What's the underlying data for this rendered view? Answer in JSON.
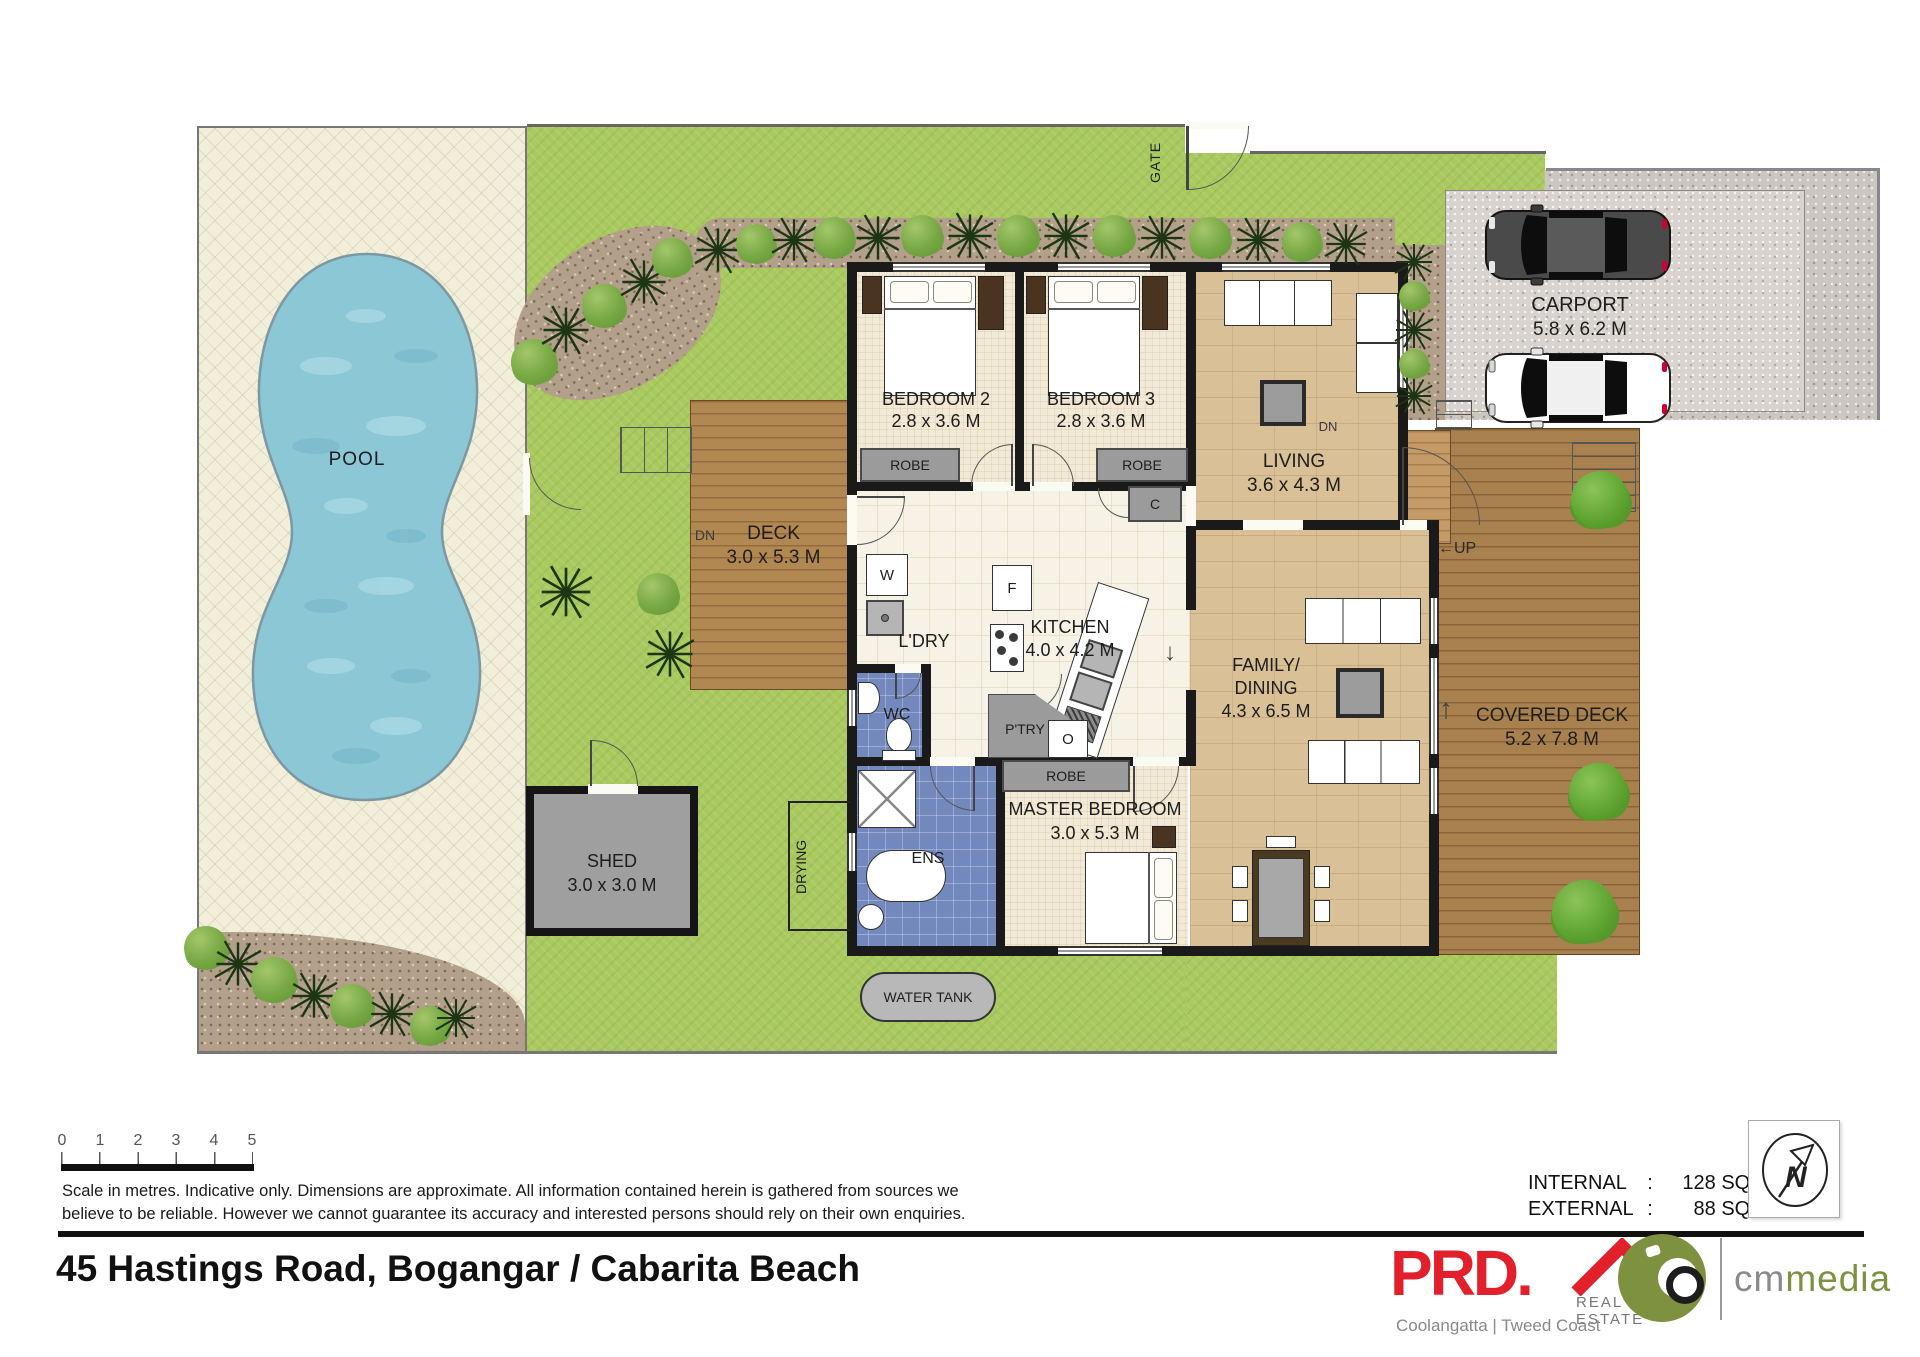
{
  "colors": {
    "prd_red": "#e2202c",
    "cm_green": "#7d9140",
    "water_blue": "#8cc7d6",
    "lawn_green": "#a9c95f",
    "mulch_brown": "#b3a08a",
    "wet_area_blue": "#7388bd",
    "deck_wood": "#b18752",
    "wall_black": "#1a1a1a"
  },
  "plan": {
    "gate_label": "GATE",
    "pool": {
      "label": "POOL"
    },
    "deck": {
      "label": "DECK",
      "dims": "3.0 x 5.3 M",
      "dn": "DN"
    },
    "shed": {
      "label": "SHED",
      "dims": "3.0 x 3.0 M"
    },
    "water_tank": {
      "label": "WATER TANK"
    },
    "drying": {
      "label": "DRYING"
    },
    "bedroom2": {
      "label": "BEDROOM 2",
      "dims": "2.8 x 3.6 M",
      "robe": "ROBE"
    },
    "bedroom3": {
      "label": "BEDROOM 3",
      "dims": "2.8 x 3.6 M",
      "robe": "ROBE"
    },
    "cupboard": "C",
    "living": {
      "label": "LIVING",
      "dims": "3.6 x 4.3 M"
    },
    "kitchen": {
      "label": "KITCHEN",
      "dims": "4.0 x 4.2 M",
      "fridge": "F",
      "oven": "O",
      "pantry": "P'TRY"
    },
    "laundry": {
      "label": "L'DRY",
      "washer": "W"
    },
    "wc": {
      "label": "WC"
    },
    "ens": {
      "label": "ENS"
    },
    "master": {
      "label": "MASTER BEDROOM",
      "dims": "3.0 x 5.3 M",
      "robe": "ROBE"
    },
    "family": {
      "line1": "FAMILY/",
      "line2": "DINING",
      "dims": "4.3 x 6.5 M"
    },
    "covered_deck": {
      "label": "COVERED DECK",
      "dims": "5.2 x 7.8 M"
    },
    "carport": {
      "label": "CARPORT",
      "dims": "5.8 x 6.2 M",
      "dn": "DN"
    },
    "up_label": "←UP",
    "arrow_up": "↑",
    "arrow_down": "↓"
  },
  "footer": {
    "scale_ticks": [
      "0",
      "1",
      "2",
      "3",
      "4",
      "5"
    ],
    "disclaimer1": "Scale in metres.  Indicative only.  Dimensions are approximate.  All information contained herein is gathered from sources we",
    "disclaimer2": "believe to be reliable.  However we cannot guarantee its accuracy and interested persons should rely on their own enquiries.",
    "address": "45 Hastings Road, Bogangar / Cabarita Beach",
    "areas": {
      "internal_label": "INTERNAL",
      "colon": ":",
      "internal_value": "128 SQ.M.",
      "external_label": "EXTERNAL",
      "external_value": "88 SQ.M."
    },
    "brand": {
      "prd": "PRD.",
      "real_estate": "REAL ESTATE",
      "region": "Coolangatta | Tweed Coast",
      "cm": "cm",
      "media": "media",
      "north": "N"
    }
  }
}
